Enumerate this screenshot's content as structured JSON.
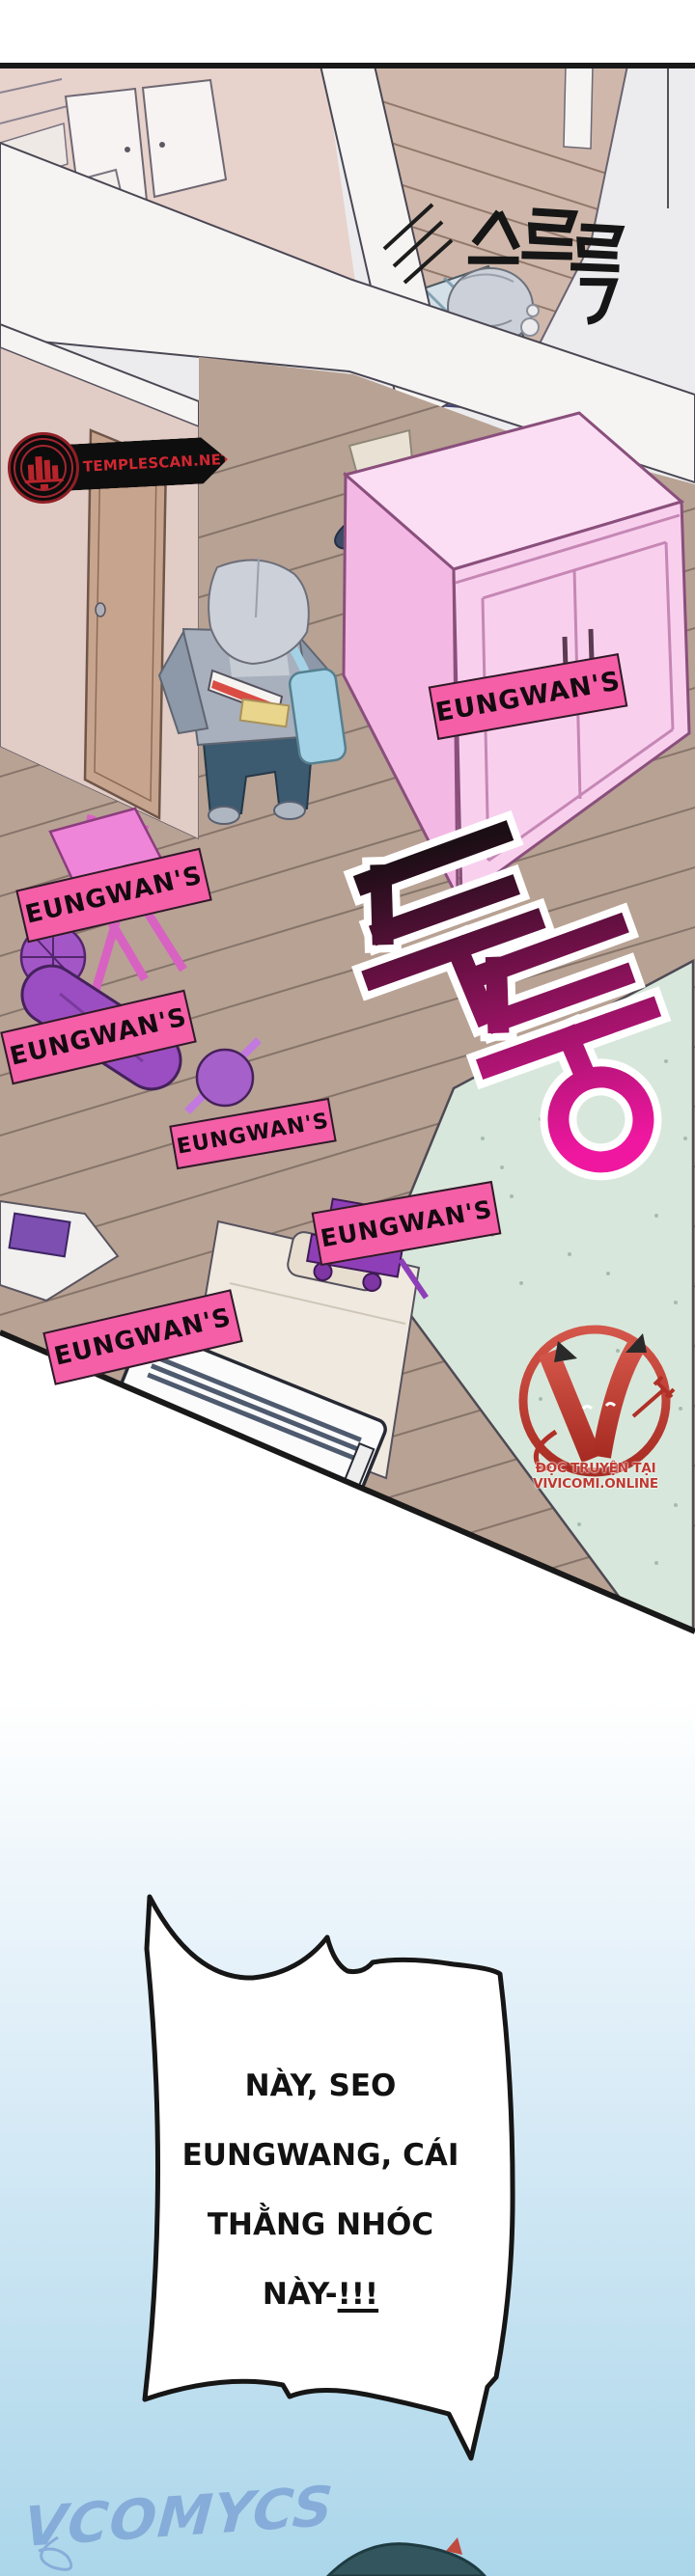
{
  "panel": {
    "sfx": {
      "slide": "스르륵",
      "thud": "두둥"
    },
    "ownership_labels": [
      "EUNGWAN'S",
      "EUNGWAN'S",
      "EUNGWAN'S",
      "EUNGWAN'S",
      "EUNGWAN'S",
      "EUNGWAN'S"
    ],
    "scan_badge": "TEMPLESCAN.NET",
    "site_watermark": "ĐỌC TRUYỆN TẠI VIVICOMI.ONLINE"
  },
  "dialogue": {
    "lines": [
      "NÀY, SEO",
      "EUNGWANG, CÁI",
      "THẰNG NHÓC"
    ],
    "last_line_prefix": "NÀY-",
    "last_line_emphasis": "!!!"
  },
  "footer": {
    "logo_text": "VCOMYCS"
  },
  "colors": {
    "label_pink": "#f45fa7",
    "sfx_magenta": "#e9179c",
    "badge_red": "#cf2731",
    "watermark_red": "#bf3a31",
    "wardrobe_pink": "#f8d0ee",
    "floor_wood": "#b8a294",
    "mat_green": "#d8e7db",
    "sky_blue": "#abd6ea",
    "logo_blue": "#7da4d6",
    "bubble_outline": "#161616"
  }
}
